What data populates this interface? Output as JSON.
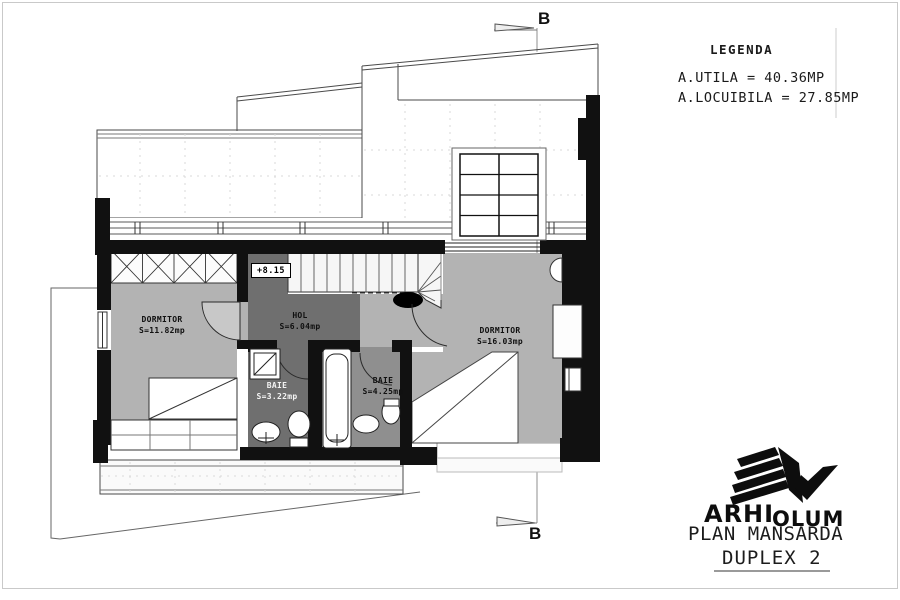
{
  "legend": {
    "title": "LEGENDA",
    "line1": "A.UTILA = 40.36MP",
    "line2": "A.LOCUIBILA = 27.85MP"
  },
  "section_marks": {
    "top": "B",
    "bottom": "B"
  },
  "plan": {
    "level_marker": "+8.15",
    "rooms": [
      {
        "name": "DORMITOR",
        "area": "S=11.82mp"
      },
      {
        "name": "HOL",
        "area": "S=6.04mp"
      },
      {
        "name": "DORMITOR",
        "area": "S=16.03mp"
      },
      {
        "name": "BAIE",
        "area": "S=3.22mp"
      },
      {
        "name": "BAIE",
        "area": "S=4.25mp"
      }
    ]
  },
  "title_block": {
    "logo_part1": "ARHI",
    "logo_part2": "OLUM",
    "plan_title": "PLAN MANSARDA",
    "plan_subtitle": "DUPLEX 2"
  },
  "colors": {
    "wall": "#111111",
    "floor_light": "#b3b3b3",
    "floor_dark": "#6f6f6f",
    "floor_mid": "#8f8f8f",
    "line": "#555555"
  }
}
